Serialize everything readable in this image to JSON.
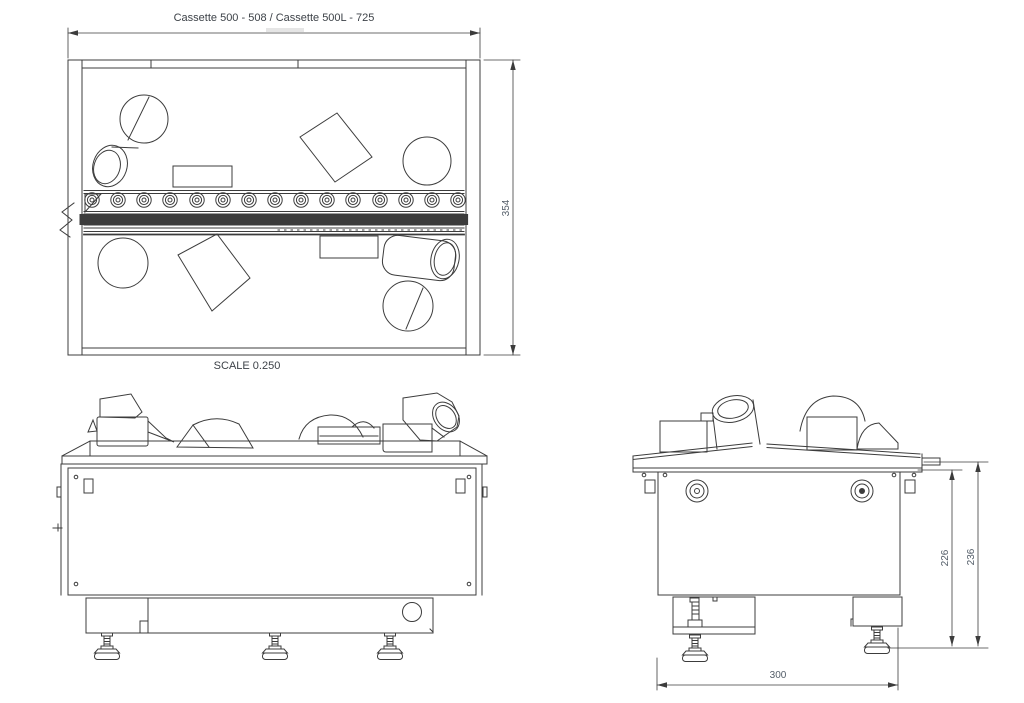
{
  "drawing": {
    "title": "Cassette 500 - 508 / Cassette 500L - 725",
    "scale_label": "SCALE  0.250",
    "dimensions": {
      "overall_depth": "354",
      "height_to_flange": "226",
      "overall_height": "236",
      "base_depth": "300"
    },
    "colors": {
      "line": "#3c3c3c",
      "dim": "#545e69",
      "ink": "#3d4248"
    }
  }
}
